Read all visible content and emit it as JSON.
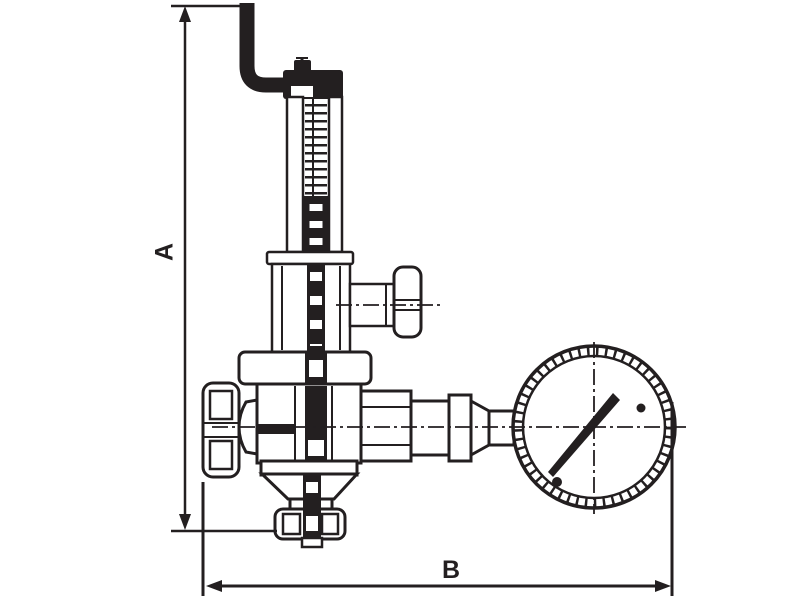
{
  "page": {
    "background": "#ffffff",
    "width_px": 800,
    "height_px": 598
  },
  "diagram": {
    "type": "technical-line-drawing",
    "subject": "Side elevation of a spring safety valve with lift lever, adjustment knobs and pressure gauge",
    "ink_color": "#231f20",
    "dimensions": {
      "height_label": "A",
      "width_label": "B"
    }
  }
}
